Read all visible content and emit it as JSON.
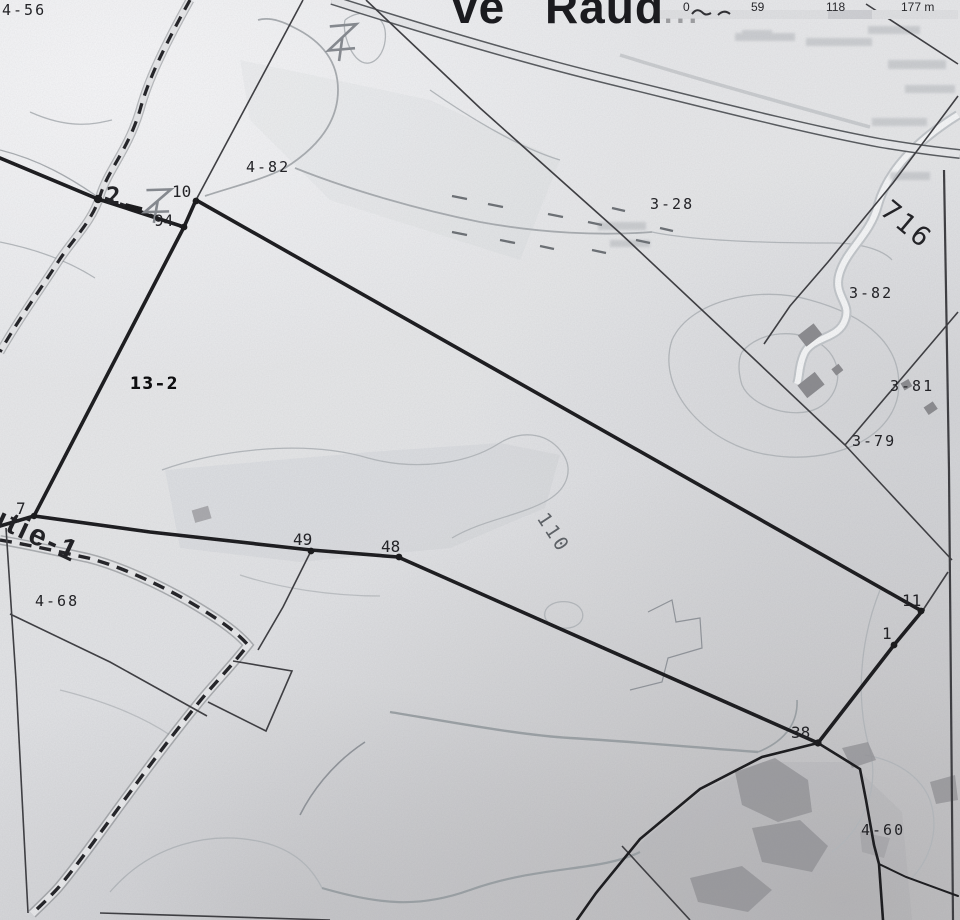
{
  "title": {
    "fragment": "ve Raud",
    "faint": "...",
    "scale_ticks": [
      "0",
      "59",
      "118",
      "177 m"
    ]
  },
  "parcel_labels": {
    "p456": "4-56",
    "p482": "4-82",
    "p328": "3-28",
    "p382": "3-82",
    "p381": "3-81",
    "p379": "3-79",
    "p132": "13-2",
    "p468": "4-68",
    "p460": "4-60"
  },
  "road_labels": {
    "highway": "716",
    "road": "utie-1"
  },
  "contour_label": "110",
  "survey_points": {
    "p2": "2",
    "p10": "10",
    "p94": "94",
    "p7": "7",
    "p49": "49",
    "p48": "48",
    "p11": "11",
    "p1": "1",
    "p38": "38"
  },
  "colors": {
    "paper": "#e7e8ea",
    "ink": "#1a1a1d",
    "boundary_thin": "#3a3a3e",
    "contour": "#b4b8bc",
    "shade": "#8f8f93"
  }
}
